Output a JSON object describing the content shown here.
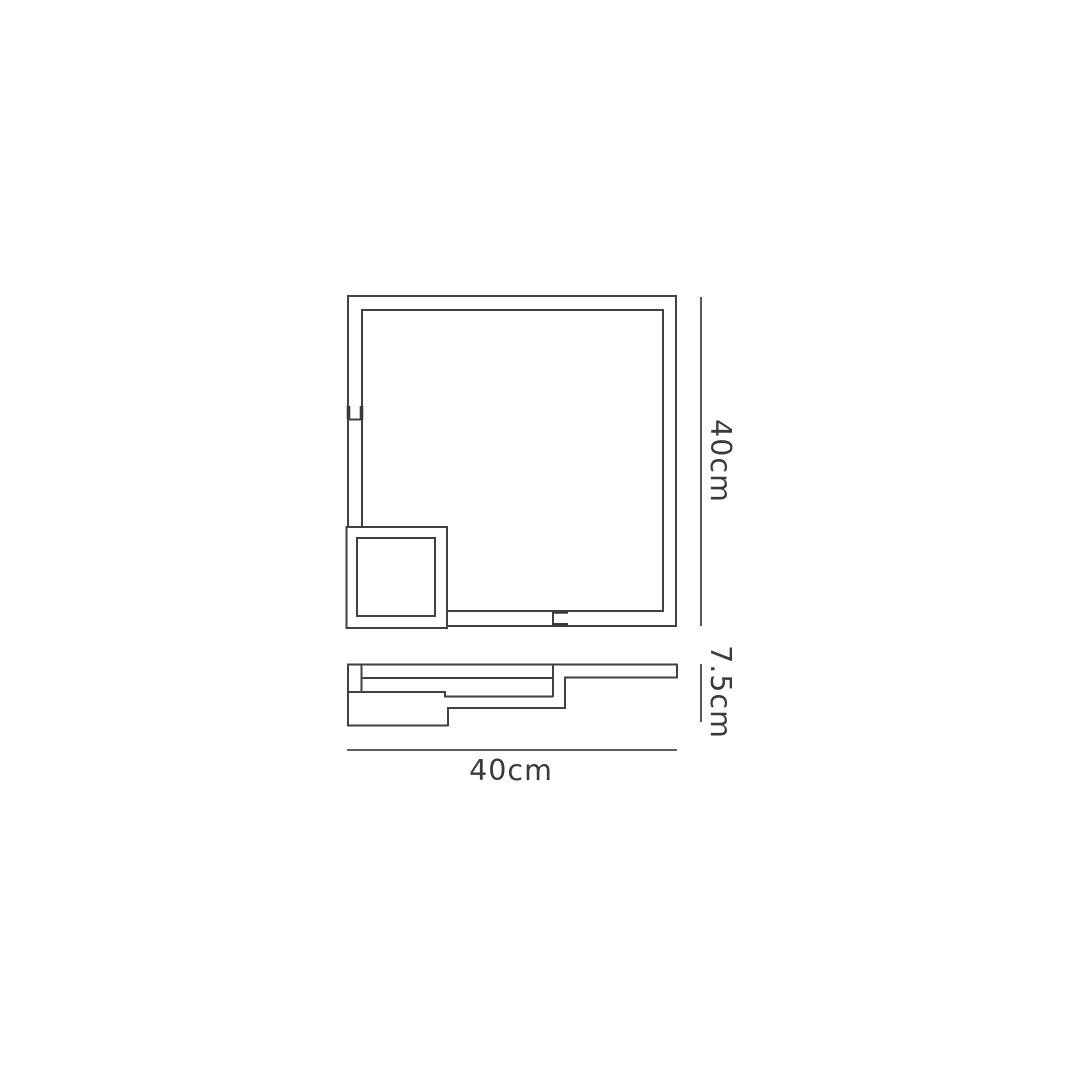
{
  "diagram": {
    "kind": "product-dimension-line-drawing",
    "labels": {
      "height": "40cm",
      "depth": "7.5cm",
      "width": "40cm"
    },
    "colors": {
      "line": "#414141",
      "text": "#3a3a3a",
      "background": "#ffffff"
    }
  }
}
